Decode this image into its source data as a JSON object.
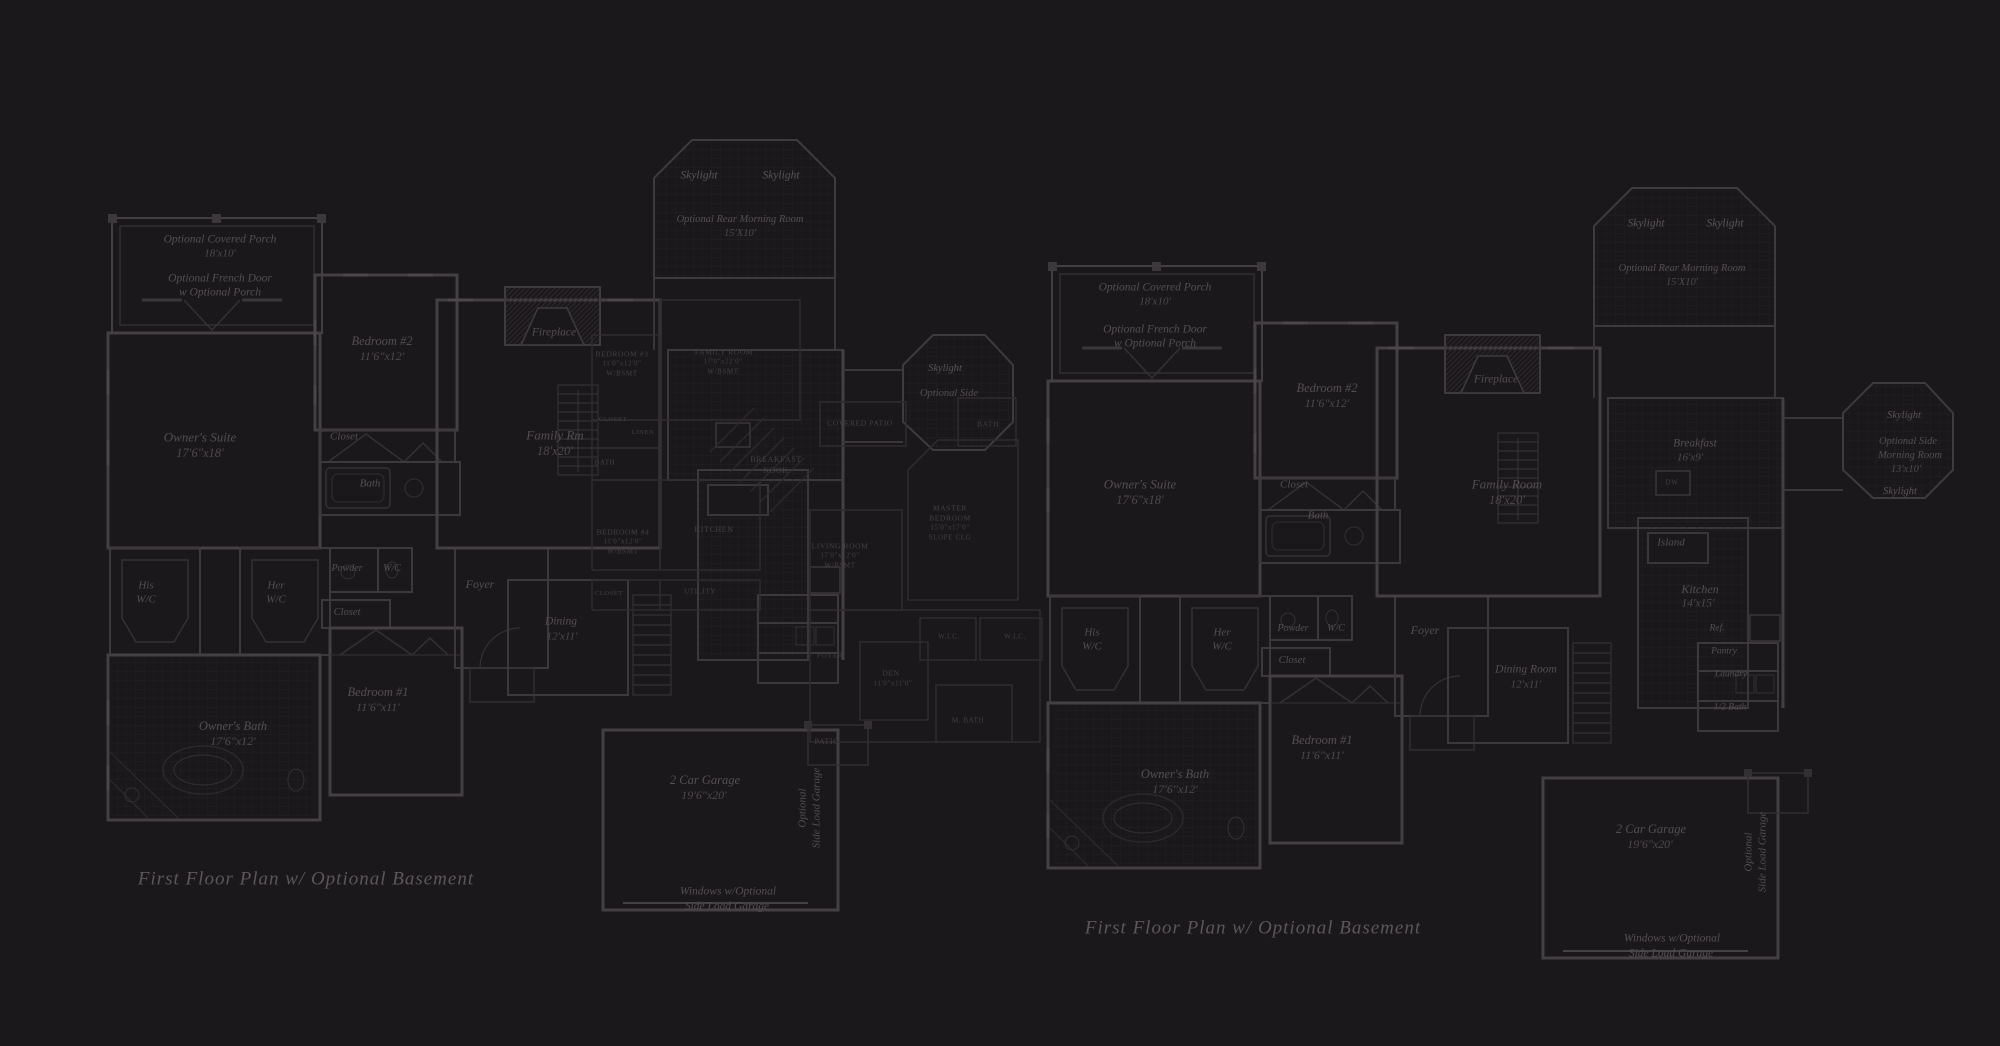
{
  "canvas": {
    "width": 2000,
    "height": 1046,
    "background": "#1b181b"
  },
  "colors": {
    "background": "#1b181b",
    "wall": "#413c3f",
    "wall_light": "#332f32",
    "hatch": "#242124",
    "label_text": "#544e50",
    "overlay_text": "#454042",
    "title_text": "#5d5658"
  },
  "plans": [
    {
      "name": "left-plan",
      "title": {
        "text": "First Floor Plan  w/ Optional Basement",
        "x": 306,
        "y": 879,
        "s": 19
      },
      "labels": [
        {
          "t": "Optional Covered Porch",
          "x": 220,
          "y": 240,
          "s": 11.5
        },
        {
          "t": "18'x10'",
          "x": 220,
          "y": 254,
          "s": 11,
          "c": "dim"
        },
        {
          "t": "Optional French Door",
          "x": 220,
          "y": 279,
          "s": 11.5
        },
        {
          "t": "w Optional Porch",
          "x": 220,
          "y": 293,
          "s": 11.5
        },
        {
          "t": "Bedroom #2",
          "x": 382,
          "y": 341,
          "s": 12.5
        },
        {
          "t": "11'6\"x12'",
          "x": 382,
          "y": 356,
          "s": 12,
          "c": "dim"
        },
        {
          "t": "Owner's Suite",
          "x": 200,
          "y": 437,
          "s": 13
        },
        {
          "t": "17'6\"x18'",
          "x": 200,
          "y": 453,
          "s": 12.5,
          "c": "dim"
        },
        {
          "t": "Closet",
          "x": 344,
          "y": 437,
          "s": 11
        },
        {
          "t": "Bath",
          "x": 370,
          "y": 484,
          "s": 11
        },
        {
          "t": "His",
          "x": 146,
          "y": 586,
          "s": 11
        },
        {
          "t": "W/C",
          "x": 146,
          "y": 600,
          "s": 11
        },
        {
          "t": "Her",
          "x": 276,
          "y": 586,
          "s": 11
        },
        {
          "t": "W/C",
          "x": 276,
          "y": 600,
          "s": 11
        },
        {
          "t": "Powder",
          "x": 347,
          "y": 569,
          "s": 10
        },
        {
          "t": "W/C",
          "x": 392,
          "y": 569,
          "s": 10
        },
        {
          "t": "Closet",
          "x": 347,
          "y": 613,
          "s": 10.5
        },
        {
          "t": "Owner's Bath",
          "x": 233,
          "y": 726,
          "s": 12.5
        },
        {
          "t": "17'6\"x12'",
          "x": 233,
          "y": 741,
          "s": 12,
          "c": "dim"
        },
        {
          "t": "Bedroom #1",
          "x": 378,
          "y": 692,
          "s": 12.5
        },
        {
          "t": "11'6\"x11'",
          "x": 378,
          "y": 707,
          "s": 12,
          "c": "dim"
        },
        {
          "t": "Family Rm",
          "x": 555,
          "y": 435,
          "s": 13
        },
        {
          "t": "18'x20'",
          "x": 555,
          "y": 451,
          "s": 12.5,
          "c": "dim"
        },
        {
          "t": "Fireplace",
          "x": 554,
          "y": 333,
          "s": 11.5
        },
        {
          "t": "Skylight",
          "x": 699,
          "y": 176,
          "s": 11.5,
          "c": "bright"
        },
        {
          "t": "Skylight",
          "x": 781,
          "y": 176,
          "s": 11.5,
          "c": "bright"
        },
        {
          "t": "Optional Rear Morning Room",
          "x": 740,
          "y": 220,
          "s": 10.5
        },
        {
          "t": "15'X10'",
          "x": 740,
          "y": 234,
          "s": 10.5,
          "c": "dim"
        },
        {
          "t": "Skylight",
          "x": 945,
          "y": 369,
          "s": 10.5,
          "c": "bright"
        },
        {
          "t": "Optional Side",
          "x": 949,
          "y": 394,
          "s": 10.5
        },
        {
          "t": "Foyer",
          "x": 480,
          "y": 584,
          "s": 12
        },
        {
          "t": "Dining",
          "x": 561,
          "y": 622,
          "s": 11.5
        },
        {
          "t": "12'x11'",
          "x": 562,
          "y": 637,
          "s": 11,
          "c": "dim"
        },
        {
          "t": "2 Car Garage",
          "x": 705,
          "y": 780,
          "s": 12.5
        },
        {
          "t": "19'6\"x20'",
          "x": 704,
          "y": 795,
          "s": 12,
          "c": "dim"
        },
        {
          "t": "Optional",
          "x": 803,
          "y": 808,
          "s": 11,
          "r": -90
        },
        {
          "t": "Side Load Garage",
          "x": 817,
          "y": 808,
          "s": 11,
          "r": -90
        },
        {
          "t": "Windows w/Optional",
          "x": 728,
          "y": 892,
          "s": 11.5
        },
        {
          "t": "Side Load Garage",
          "x": 727,
          "y": 907,
          "s": 11.5
        },
        {
          "t": "PATIO",
          "x": 827,
          "y": 742,
          "s": 8,
          "c": "caps"
        },
        {
          "t": "BREAKFAST",
          "x": 776,
          "y": 460,
          "s": 8,
          "c": "caps"
        },
        {
          "t": "NOOK",
          "x": 776,
          "y": 471,
          "s": 8,
          "c": "caps"
        },
        {
          "t": "KITCHEN",
          "x": 714,
          "y": 530,
          "s": 8,
          "c": "caps"
        },
        {
          "t": "BEDROOM #3",
          "x": 622,
          "y": 354,
          "s": 7.5,
          "c": "caps"
        },
        {
          "t": "11'0\"x12'0\"",
          "x": 622,
          "y": 364,
          "s": 7,
          "c": "caps"
        },
        {
          "t": "W/BSMT",
          "x": 622,
          "y": 374,
          "s": 7,
          "c": "caps"
        },
        {
          "t": "FAMILY ROOM",
          "x": 724,
          "y": 352,
          "s": 7.5,
          "c": "caps"
        },
        {
          "t": "17'0\"x22'0\"",
          "x": 723,
          "y": 362,
          "s": 7,
          "c": "caps"
        },
        {
          "t": "W/BSMT",
          "x": 723,
          "y": 372,
          "s": 7,
          "c": "caps"
        },
        {
          "t": "CLOSET",
          "x": 613,
          "y": 420,
          "s": 6.5,
          "c": "caps"
        },
        {
          "t": "LINEN",
          "x": 643,
          "y": 433,
          "s": 6.5,
          "c": "caps"
        },
        {
          "t": "BATH",
          "x": 605,
          "y": 463,
          "s": 7,
          "c": "caps"
        },
        {
          "t": "BEDROOM #4",
          "x": 623,
          "y": 532,
          "s": 7.5,
          "c": "caps"
        },
        {
          "t": "11'0\"x12'0\"",
          "x": 623,
          "y": 542,
          "s": 7,
          "c": "caps"
        },
        {
          "t": "W/BSMT",
          "x": 623,
          "y": 552,
          "s": 7,
          "c": "caps"
        },
        {
          "t": "CLOSET",
          "x": 609,
          "y": 594,
          "s": 6.5,
          "c": "caps"
        },
        {
          "t": "UTILITY",
          "x": 700,
          "y": 592,
          "s": 7,
          "c": "caps"
        },
        {
          "t": "COVERED PATIO",
          "x": 860,
          "y": 423,
          "s": 7.5,
          "c": "caps"
        },
        {
          "t": "BATH",
          "x": 988,
          "y": 424,
          "s": 7.5,
          "c": "caps"
        },
        {
          "t": "MASTER",
          "x": 950,
          "y": 508,
          "s": 7.5,
          "c": "caps"
        },
        {
          "t": "BEDROOM",
          "x": 950,
          "y": 518,
          "s": 7.5,
          "c": "caps"
        },
        {
          "t": "15'0\"x17'0\"",
          "x": 950,
          "y": 528,
          "s": 7,
          "c": "caps"
        },
        {
          "t": "SLOPE CLG",
          "x": 950,
          "y": 538,
          "s": 7,
          "c": "caps"
        },
        {
          "t": "LIVING ROOM",
          "x": 840,
          "y": 546,
          "s": 7.5,
          "c": "caps"
        },
        {
          "t": "17'0\"x12'0\"",
          "x": 840,
          "y": 556,
          "s": 7,
          "c": "caps"
        },
        {
          "t": "W/BSMT",
          "x": 840,
          "y": 566,
          "s": 7,
          "c": "caps"
        },
        {
          "t": "FOYER",
          "x": 830,
          "y": 656,
          "s": 7,
          "c": "caps"
        },
        {
          "t": "DEN",
          "x": 891,
          "y": 673,
          "s": 7.5,
          "c": "caps"
        },
        {
          "t": "11'0\"x11'0\"",
          "x": 893,
          "y": 684,
          "s": 7,
          "c": "caps"
        },
        {
          "t": "W.I.C.",
          "x": 949,
          "y": 637,
          "s": 7,
          "c": "caps"
        },
        {
          "t": "W.I.C.",
          "x": 1015,
          "y": 637,
          "s": 7,
          "c": "caps"
        },
        {
          "t": "M. BATH",
          "x": 968,
          "y": 721,
          "s": 7,
          "c": "caps"
        }
      ]
    },
    {
      "name": "right-plan",
      "title": {
        "text": "First Floor Plan  w/ Optional Basement",
        "x": 1253,
        "y": 928,
        "s": 19
      },
      "labels": [
        {
          "t": "Optional Covered Porch",
          "x": 1155,
          "y": 288,
          "s": 11.5
        },
        {
          "t": "18'x10'",
          "x": 1155,
          "y": 302,
          "s": 11,
          "c": "dim"
        },
        {
          "t": "Optional French Door",
          "x": 1155,
          "y": 330,
          "s": 11.5
        },
        {
          "t": "w Optional Porch",
          "x": 1155,
          "y": 344,
          "s": 11.5
        },
        {
          "t": "Bedroom #2",
          "x": 1327,
          "y": 388,
          "s": 12.5
        },
        {
          "t": "11'6\"x12'",
          "x": 1327,
          "y": 403,
          "s": 12,
          "c": "dim"
        },
        {
          "t": "Owner's Suite",
          "x": 1140,
          "y": 484,
          "s": 13
        },
        {
          "t": "17'6\"x18'",
          "x": 1140,
          "y": 500,
          "s": 12.5,
          "c": "dim"
        },
        {
          "t": "Closet",
          "x": 1294,
          "y": 485,
          "s": 11
        },
        {
          "t": "Bath",
          "x": 1318,
          "y": 516,
          "s": 11
        },
        {
          "t": "His",
          "x": 1092,
          "y": 633,
          "s": 11
        },
        {
          "t": "W/C",
          "x": 1092,
          "y": 647,
          "s": 11
        },
        {
          "t": "Her",
          "x": 1222,
          "y": 633,
          "s": 11
        },
        {
          "t": "W/C",
          "x": 1222,
          "y": 647,
          "s": 11
        },
        {
          "t": "Powder",
          "x": 1293,
          "y": 629,
          "s": 10
        },
        {
          "t": "W/C",
          "x": 1336,
          "y": 629,
          "s": 10
        },
        {
          "t": "Closet",
          "x": 1292,
          "y": 661,
          "s": 10.5
        },
        {
          "t": "Owner's Bath",
          "x": 1175,
          "y": 774,
          "s": 12.5
        },
        {
          "t": "17'6\"x12'",
          "x": 1175,
          "y": 789,
          "s": 12,
          "c": "dim"
        },
        {
          "t": "Bedroom #1",
          "x": 1322,
          "y": 740,
          "s": 12.5
        },
        {
          "t": "11'6\"x11'",
          "x": 1322,
          "y": 755,
          "s": 12,
          "c": "dim"
        },
        {
          "t": "Family Room",
          "x": 1507,
          "y": 484,
          "s": 13
        },
        {
          "t": "18'x20'",
          "x": 1507,
          "y": 500,
          "s": 12.5,
          "c": "dim"
        },
        {
          "t": "Fireplace",
          "x": 1496,
          "y": 380,
          "s": 11.5
        },
        {
          "t": "Skylight",
          "x": 1646,
          "y": 224,
          "s": 11.5,
          "c": "bright"
        },
        {
          "t": "Skylight",
          "x": 1725,
          "y": 224,
          "s": 11.5,
          "c": "bright"
        },
        {
          "t": "Optional Rear Morning Room",
          "x": 1682,
          "y": 269,
          "s": 10.5
        },
        {
          "t": "15'X10'",
          "x": 1682,
          "y": 283,
          "s": 10.5,
          "c": "dim"
        },
        {
          "t": "Breakfast",
          "x": 1695,
          "y": 444,
          "s": 11.5
        },
        {
          "t": "16'x9'",
          "x": 1690,
          "y": 458,
          "s": 11,
          "c": "dim"
        },
        {
          "t": "DW",
          "x": 1672,
          "y": 483,
          "s": 7,
          "c": "caps"
        },
        {
          "t": "Island",
          "x": 1671,
          "y": 543,
          "s": 11
        },
        {
          "t": "Kitchen",
          "x": 1700,
          "y": 589,
          "s": 12
        },
        {
          "t": "14'x15'",
          "x": 1698,
          "y": 604,
          "s": 11.5,
          "c": "dim"
        },
        {
          "t": "Ref.",
          "x": 1717,
          "y": 629,
          "s": 9.5
        },
        {
          "t": "Pantry",
          "x": 1724,
          "y": 652,
          "s": 9.5
        },
        {
          "t": "Laundry",
          "x": 1731,
          "y": 675,
          "s": 9.5
        },
        {
          "t": "1/2 Bath",
          "x": 1730,
          "y": 708,
          "s": 9.5
        },
        {
          "t": "Dining Room",
          "x": 1526,
          "y": 670,
          "s": 11.5
        },
        {
          "t": "12'x11'",
          "x": 1526,
          "y": 685,
          "s": 11,
          "c": "dim"
        },
        {
          "t": "Foyer",
          "x": 1425,
          "y": 630,
          "s": 12
        },
        {
          "t": "2 Car Garage",
          "x": 1651,
          "y": 829,
          "s": 12.5
        },
        {
          "t": "19'6\"x20'",
          "x": 1650,
          "y": 844,
          "s": 12,
          "c": "dim"
        },
        {
          "t": "Optional",
          "x": 1749,
          "y": 852,
          "s": 11,
          "r": -90
        },
        {
          "t": "Side Load Garage",
          "x": 1763,
          "y": 852,
          "s": 11,
          "r": -90
        },
        {
          "t": "Windows w/Optional",
          "x": 1672,
          "y": 939,
          "s": 11.5
        },
        {
          "t": "Side Load Garage",
          "x": 1671,
          "y": 954,
          "s": 11.5
        },
        {
          "t": "Skylight",
          "x": 1904,
          "y": 416,
          "s": 10.5,
          "c": "bright"
        },
        {
          "t": "Optional Side",
          "x": 1908,
          "y": 442,
          "s": 10.5
        },
        {
          "t": "Morning Room",
          "x": 1910,
          "y": 456,
          "s": 10.5
        },
        {
          "t": "13'x10'",
          "x": 1906,
          "y": 470,
          "s": 10.5,
          "c": "dim"
        },
        {
          "t": "Skylight",
          "x": 1900,
          "y": 492,
          "s": 10.5,
          "c": "bright"
        }
      ]
    }
  ]
}
